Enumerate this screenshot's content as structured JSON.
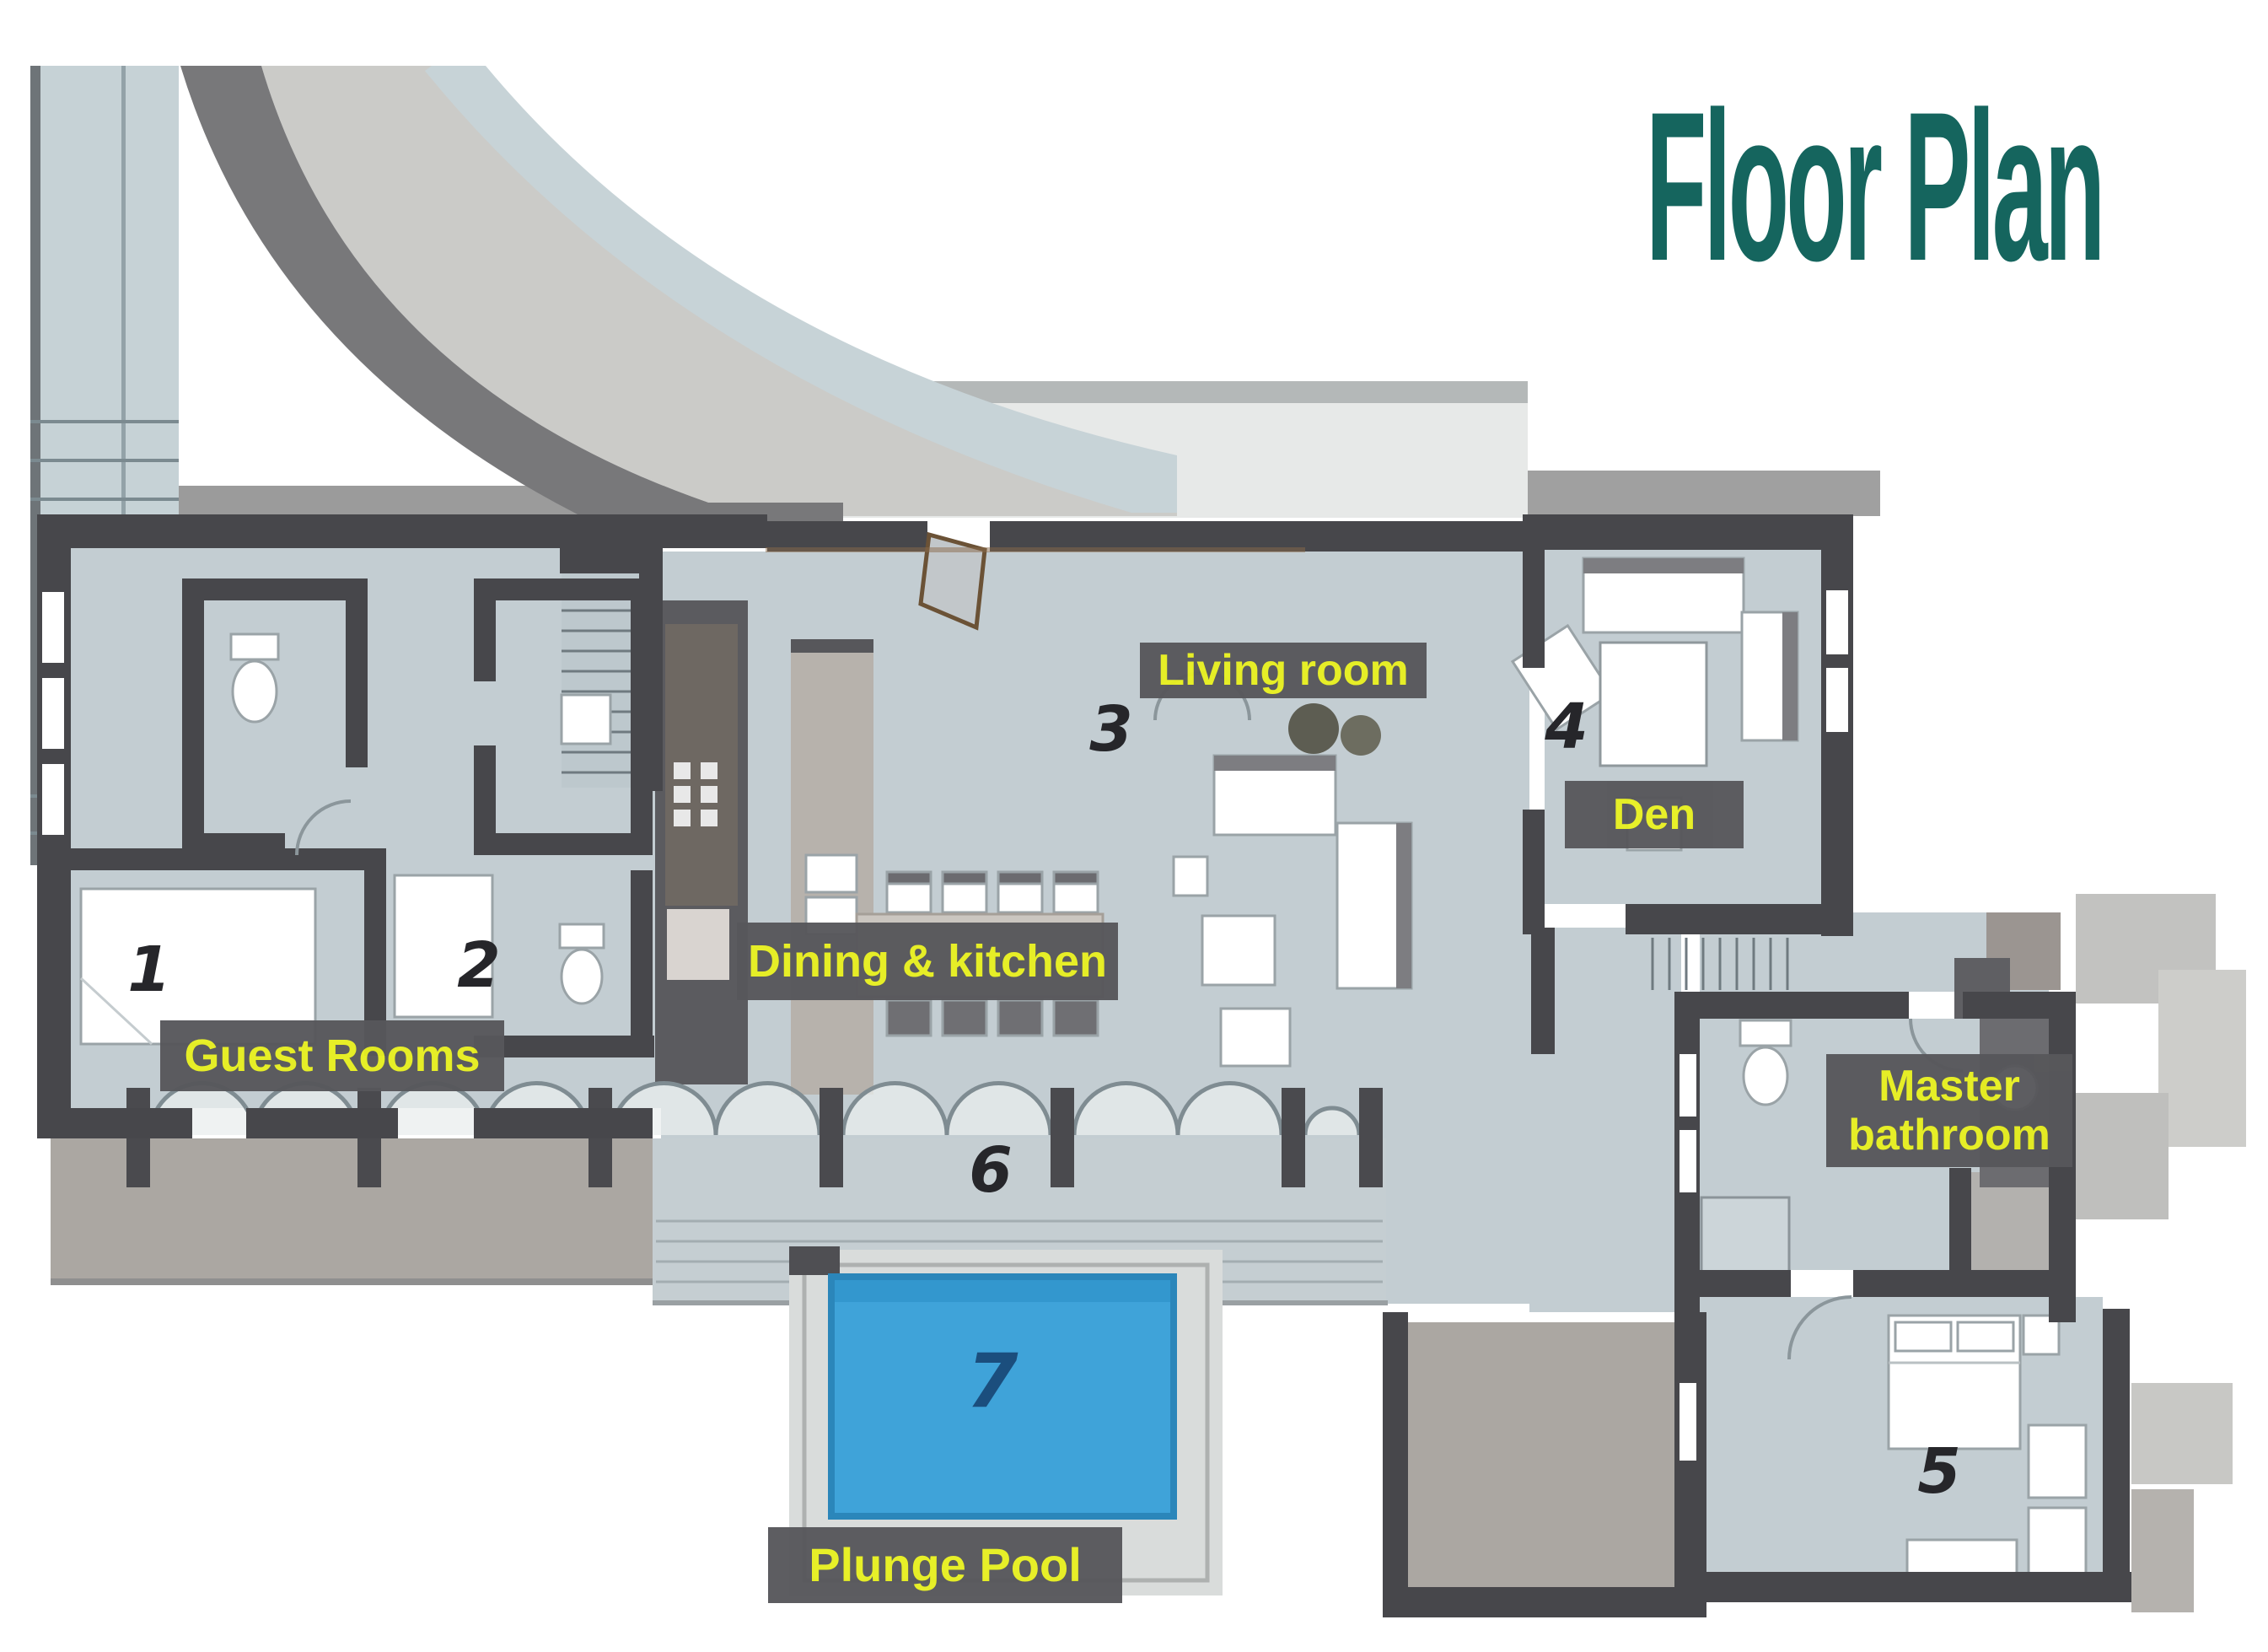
{
  "title": "Floor Plan",
  "labels": {
    "living_room": "Living room",
    "den": "Den",
    "dining_kitchen": "Dining & kitchen",
    "guest_rooms": "Guest Rooms",
    "master_bathroom": "Master bathroom",
    "plunge_pool": "Plunge Pool"
  },
  "room_numbers": {
    "guest_room_1": "1",
    "guest_room_2": "2",
    "living_room": "3",
    "den": "4",
    "master_bedroom": "5",
    "terrace": "6",
    "plunge_pool": "7"
  },
  "colors": {
    "title_text": "#15655E",
    "label_text": "#E8F021",
    "label_background": "#57575B",
    "pool_water": "#3FA3D9",
    "pool_number": "#1B4E7D",
    "floor": "#C3CDD2",
    "wall": "#47474B",
    "terrace": "#ABA7A2",
    "room_number": "#26262A"
  }
}
